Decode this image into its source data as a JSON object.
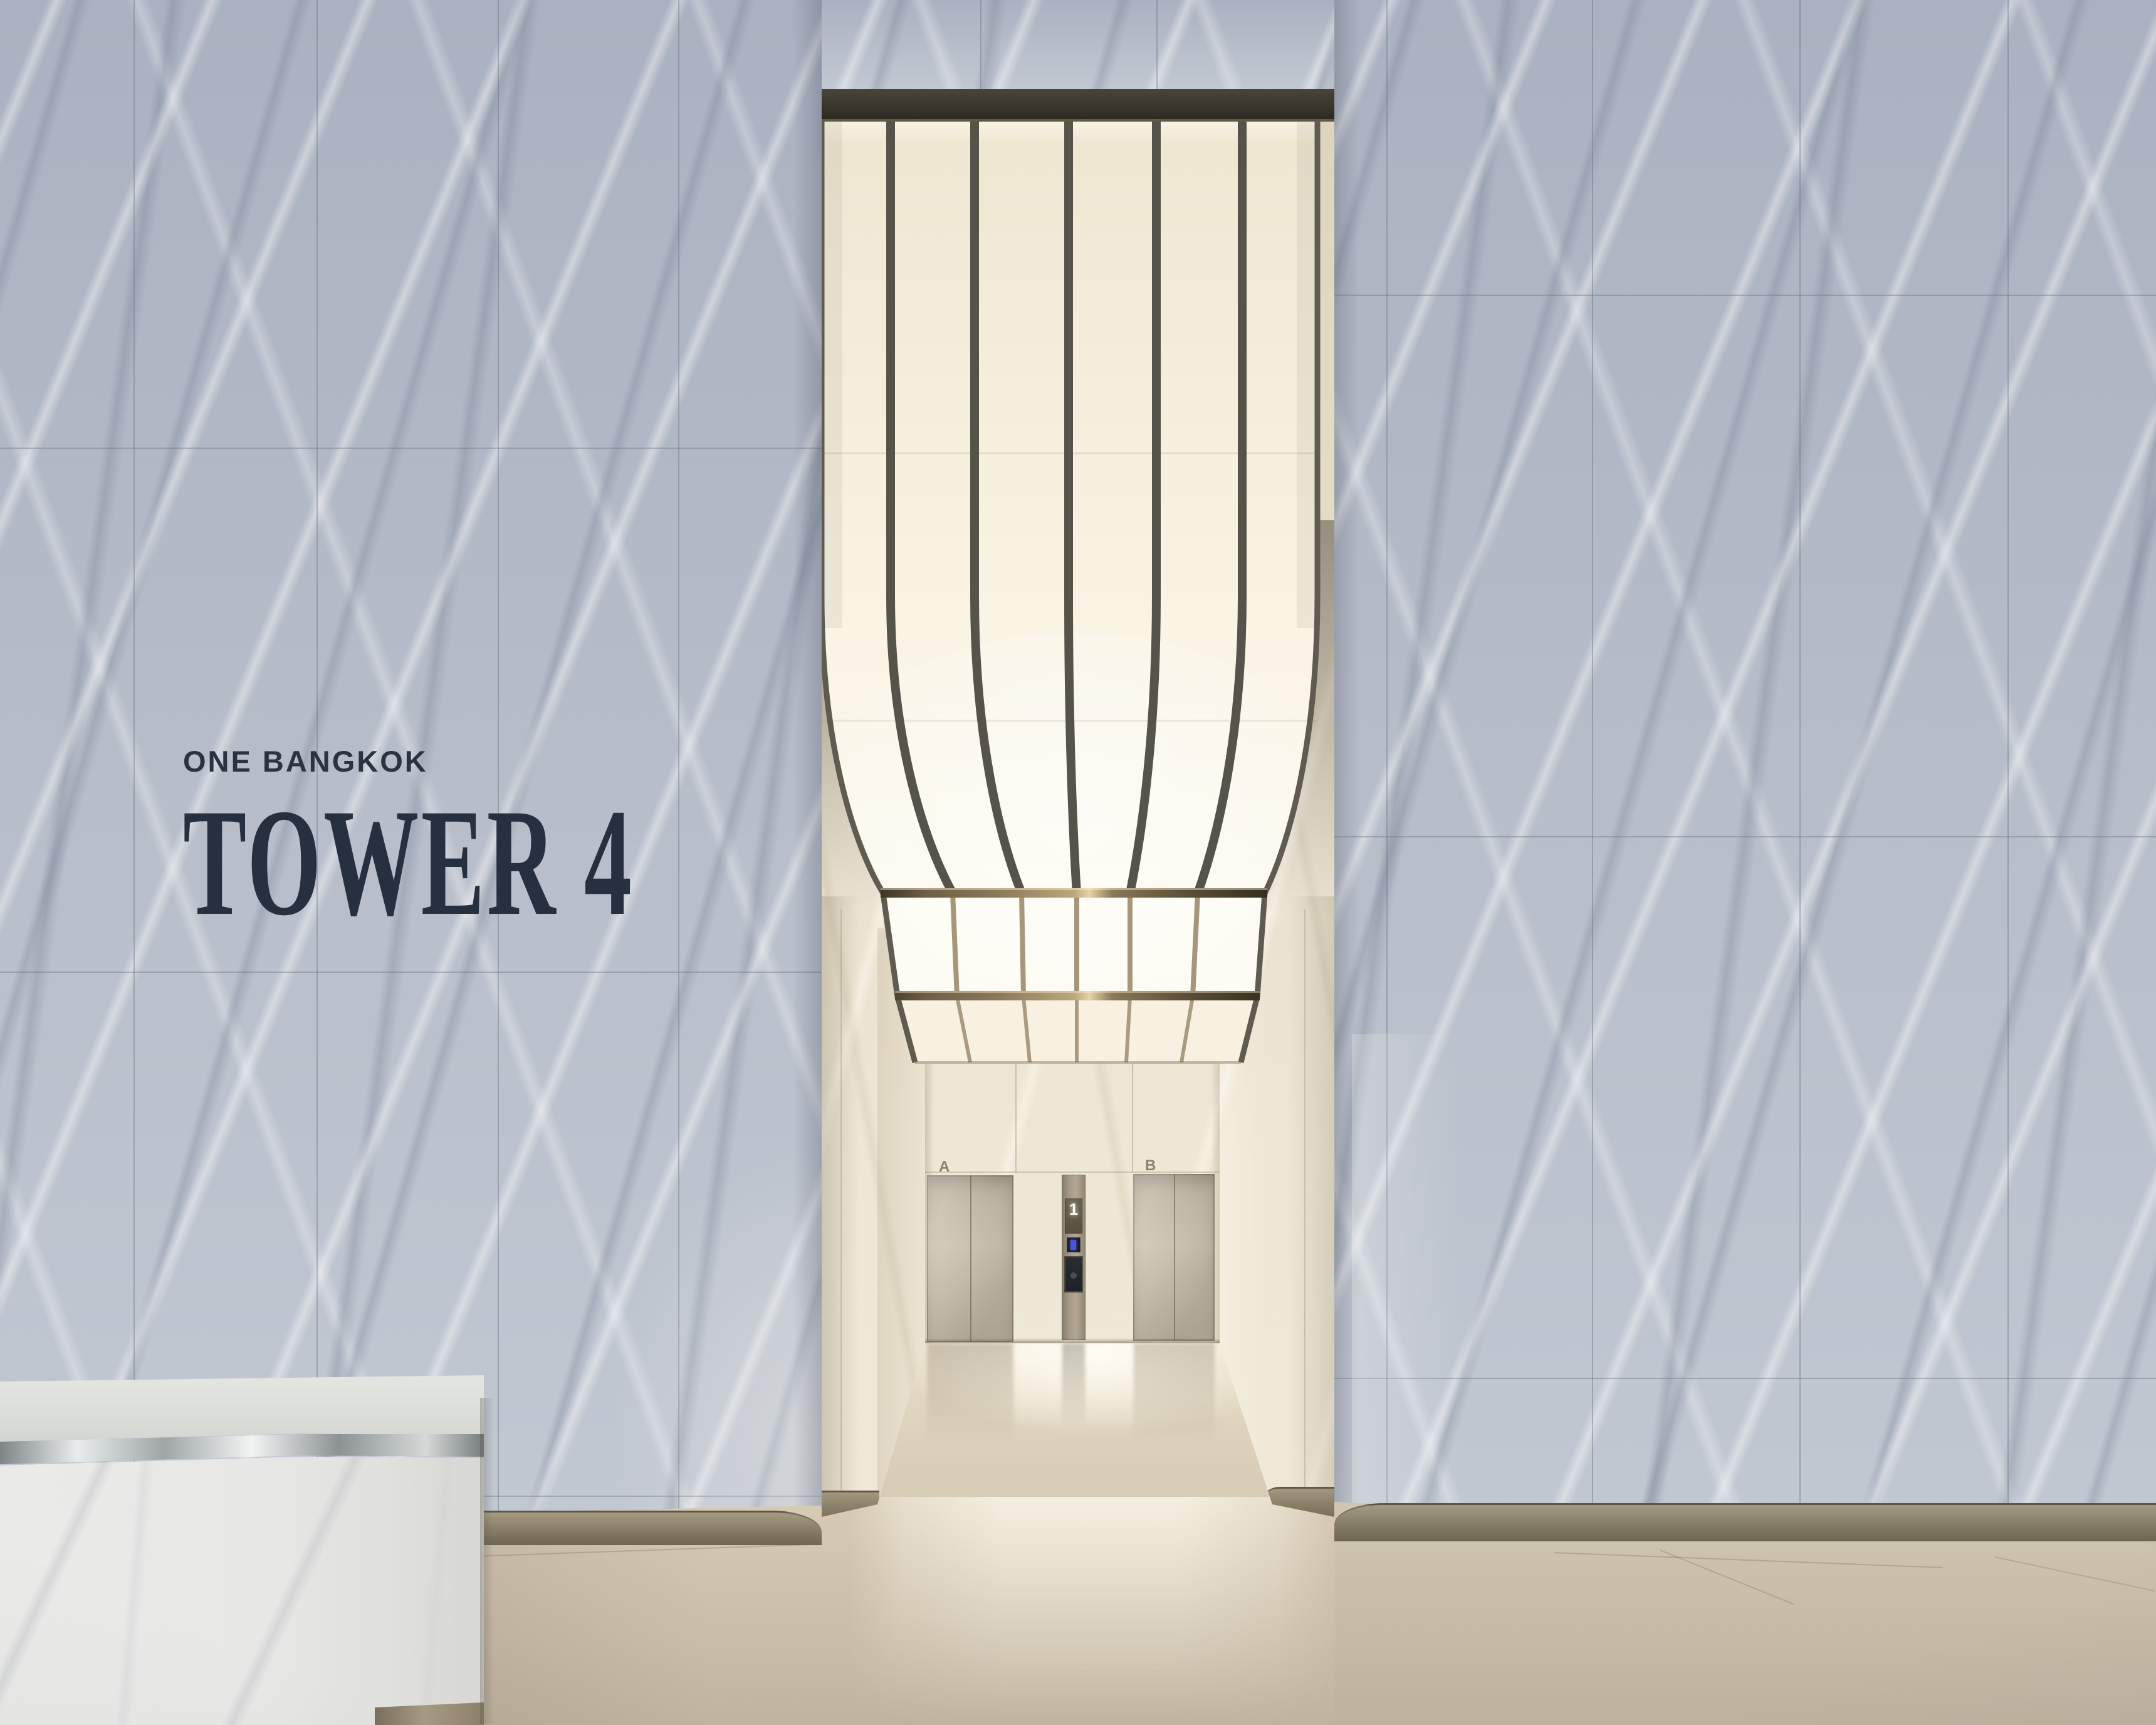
{
  "scene": {
    "signage": {
      "project": "ONE BANGKOK",
      "tower": "TOWER 4"
    },
    "elevators": [
      {
        "label": "A"
      },
      {
        "label": "B"
      }
    ],
    "panel": {
      "floor_indicator": "1"
    }
  },
  "palette": {
    "signage-ink": "#2a3342",
    "marble-grey": "#b6bdc9",
    "stone-cream": "#e8dfcb",
    "glow-warm": "#f8f3e4",
    "glow-bright": "#fdfaf1",
    "frame-dark": "#39352c",
    "bronze-bar": "#8a7857",
    "door-metal": "#c3b9a8",
    "steel": "#b6bcc1",
    "floor-beige": "#d6cab5",
    "skirting-bronze": "#8d8269"
  }
}
